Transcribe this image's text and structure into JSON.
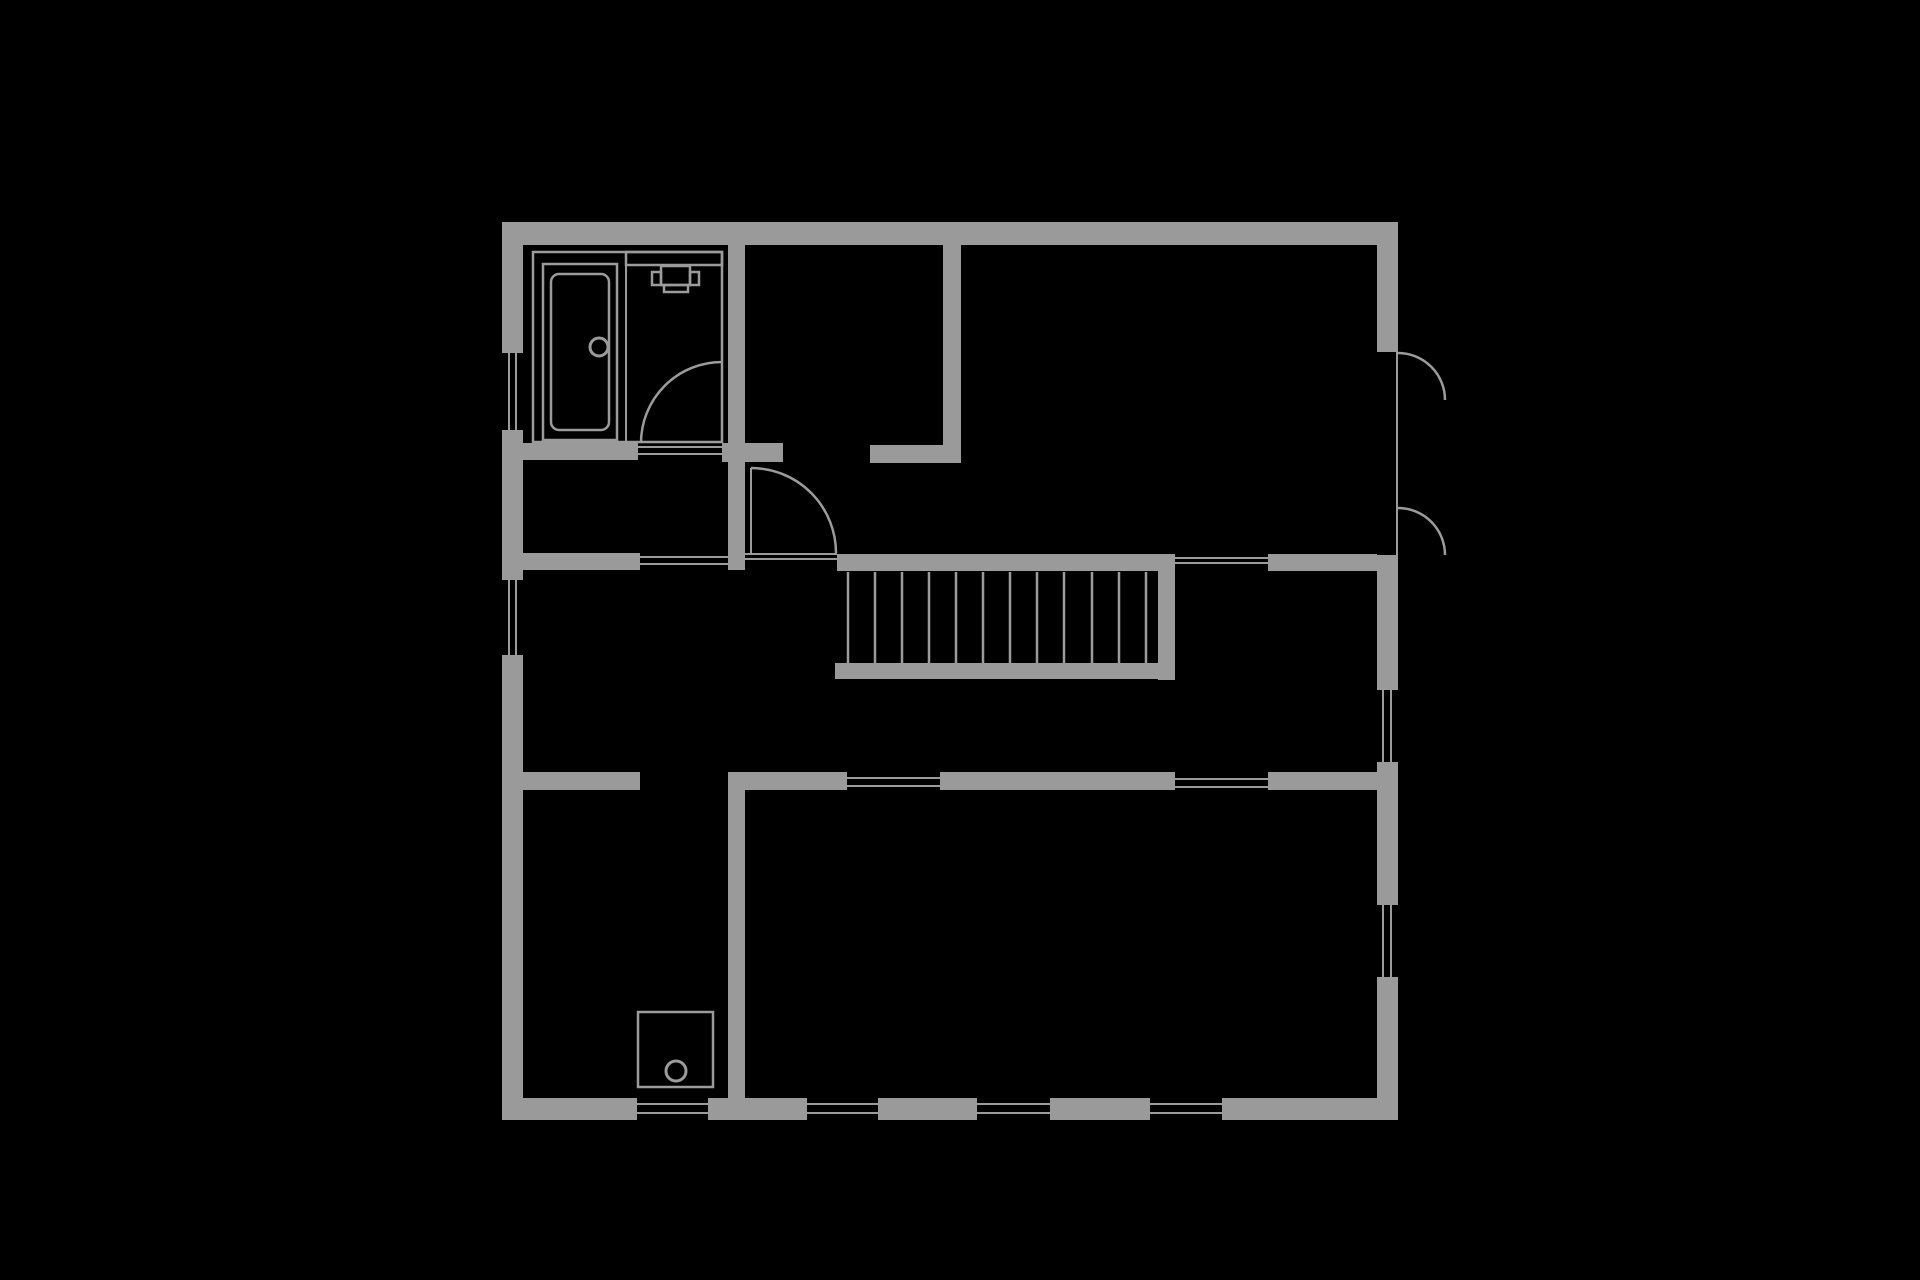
{
  "meta": {
    "type": "architectural-floor-plan",
    "description": "Single-storey floor plan drawn in gray on black background"
  },
  "canvas": {
    "width": 1920,
    "height": 1280
  },
  "colors": {
    "background": "#000000",
    "wall": "#9a9a9a",
    "thin_line": "#9b9b9b"
  },
  "plan": {
    "wall_segments": [
      [
        502,
        222,
        896,
        23
      ],
      [
        502,
        222,
        21,
        131
      ],
      [
        502,
        430,
        21,
        150
      ],
      [
        502,
        655,
        21,
        465
      ],
      [
        1377,
        222,
        21,
        130
      ],
      [
        1377,
        555,
        21,
        135
      ],
      [
        1377,
        762,
        21,
        143
      ],
      [
        1377,
        977,
        21,
        143
      ],
      [
        502,
        1098,
        135,
        22
      ],
      [
        708,
        1098,
        99,
        22
      ],
      [
        878,
        1098,
        99,
        22
      ],
      [
        1050,
        1098,
        100,
        22
      ],
      [
        1222,
        1098,
        176,
        22
      ],
      [
        728,
        245,
        17,
        325
      ],
      [
        943,
        245,
        18,
        200
      ],
      [
        512,
        443,
        126,
        17
      ],
      [
        722,
        443,
        61,
        19
      ],
      [
        870,
        445,
        91,
        18
      ],
      [
        512,
        553,
        128,
        17
      ],
      [
        837,
        554,
        338,
        17
      ],
      [
        1268,
        554,
        109,
        17
      ],
      [
        1158,
        571,
        17,
        109
      ],
      [
        835,
        663,
        340,
        16
      ],
      [
        512,
        772,
        128,
        18
      ],
      [
        728,
        772,
        119,
        18
      ],
      [
        940,
        772,
        235,
        18
      ],
      [
        1268,
        772,
        109,
        18
      ],
      [
        728,
        790,
        17,
        330
      ]
    ],
    "window_glass_lines": [
      [
        508,
        353,
        2,
        77
      ],
      [
        515,
        353,
        2,
        77
      ],
      [
        508,
        580,
        2,
        75
      ],
      [
        515,
        580,
        2,
        75
      ],
      [
        1382,
        690,
        2,
        72
      ],
      [
        1390,
        690,
        2,
        72
      ],
      [
        1382,
        905,
        2,
        72
      ],
      [
        1390,
        905,
        2,
        72
      ],
      [
        1396,
        352,
        2,
        203
      ],
      [
        637,
        1103,
        71,
        2
      ],
      [
        637,
        1112,
        71,
        2
      ],
      [
        807,
        1103,
        71,
        2
      ],
      [
        807,
        1112,
        71,
        2
      ],
      [
        977,
        1103,
        73,
        2
      ],
      [
        977,
        1112,
        73,
        2
      ],
      [
        1150,
        1103,
        72,
        2
      ],
      [
        1150,
        1112,
        72,
        2
      ]
    ],
    "threshold_lines": [
      [
        638,
        446,
        84,
        2
      ],
      [
        638,
        453,
        84,
        2
      ],
      [
        640,
        556,
        88,
        2
      ],
      [
        640,
        563,
        88,
        2
      ],
      [
        745,
        553,
        92,
        2
      ],
      [
        745,
        558,
        92,
        2
      ],
      [
        1175,
        557,
        93,
        2
      ],
      [
        1175,
        562,
        93,
        2
      ],
      [
        847,
        777,
        93,
        2
      ],
      [
        847,
        785,
        93,
        2
      ],
      [
        1175,
        778,
        93,
        2
      ],
      [
        1175,
        786,
        93,
        2
      ]
    ],
    "door_leaves": [
      [
        721,
        362,
        2,
        81
      ],
      [
        750,
        468,
        2,
        85
      ]
    ],
    "door_swing_arcs": [
      "M722 362 A81 81 0 0 0 641 443",
      "M751 468 A85 85 0 0 1 836 553",
      "M1398 353 A47 47 0 0 1 1445 400",
      "M1398 508 A47 47 0 0 1 1445 555"
    ],
    "stairs": {
      "risers_x": [
        848,
        875,
        902,
        929,
        956,
        983,
        1010,
        1037,
        1064,
        1092,
        1119,
        1146
      ],
      "riser_top_y": 572,
      "riser_bottom_y": 663
    },
    "fixtures": {
      "bathroom_outline": [
        533,
        252,
        189,
        190
      ],
      "bathroom_divider": [
        625,
        252,
        2,
        190
      ],
      "vanity_counter": [
        626,
        252,
        96,
        13
      ],
      "bathtub_outer": [
        543,
        264,
        74,
        176
      ],
      "bathtub_inner": [
        551,
        274,
        58,
        156
      ],
      "bathtub_inner_radius": 8,
      "bathtub_drain": {
        "cx": 599,
        "cy": 347,
        "r": 9
      },
      "sink": {
        "basin": [
          661,
          266,
          29,
          19
        ],
        "tab_left": [
          652,
          272,
          9,
          13
        ],
        "tab_right": [
          690,
          272,
          9,
          13
        ],
        "lip": [
          664,
          285,
          24,
          7
        ]
      },
      "boiler": {
        "body": [
          638,
          1012,
          75,
          75
        ],
        "dial": {
          "cx": 676,
          "cy": 1071,
          "r": 10
        }
      }
    }
  }
}
